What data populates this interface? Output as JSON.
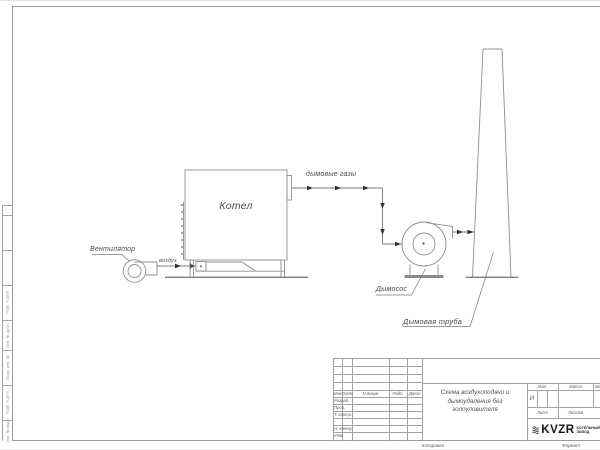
{
  "colors": {
    "line": "#8f8f8f",
    "frame": "#9c9c9c",
    "text": "#4a4a4a",
    "arrow": "#2e2e2e",
    "logo": "#161616",
    "base_fill": "#8a8a8a"
  },
  "diagram": {
    "fan_label": "Вентилятор",
    "air_flow_label": "воздух",
    "boiler_label": "Котел",
    "flue_gas_label": "дымовые газы",
    "smoke_exhauster_label": "Дымосос",
    "chimney_label": "Дымовая труба"
  },
  "title_block": {
    "doc_title_lines": [
      "Схема воздухоподачи и",
      "дымоудаления без",
      "золоуловителя"
    ],
    "header_cells": {
      "izm": "Изм",
      "list": "Лист",
      "doc": "N докум",
      "podp": "Подп.",
      "data": "Дата"
    },
    "staff_rows": [
      "Разраб.",
      "Пров.",
      "Т. контр.",
      "",
      "Н. контр.",
      "Утв."
    ],
    "lit_header": "Лит.",
    "lit_value": "И",
    "mass_header": "Масса",
    "scale_header": "Масштаб",
    "sheet_header": "Лист",
    "sheets_header": "Листов",
    "logo_text": "KVZR",
    "logo_caption_line1": "КОТЕЛЬНЫЙ",
    "logo_caption_line2": "ЗАВОД",
    "copied_by_label": "Копировал",
    "format_label": "Формат"
  },
  "side_stamp": {
    "cells": [
      "Подп. и дата",
      "Инв. № дубл.",
      "Взам. инв. №",
      "Подп. и дата",
      "Инв. № подл."
    ]
  }
}
